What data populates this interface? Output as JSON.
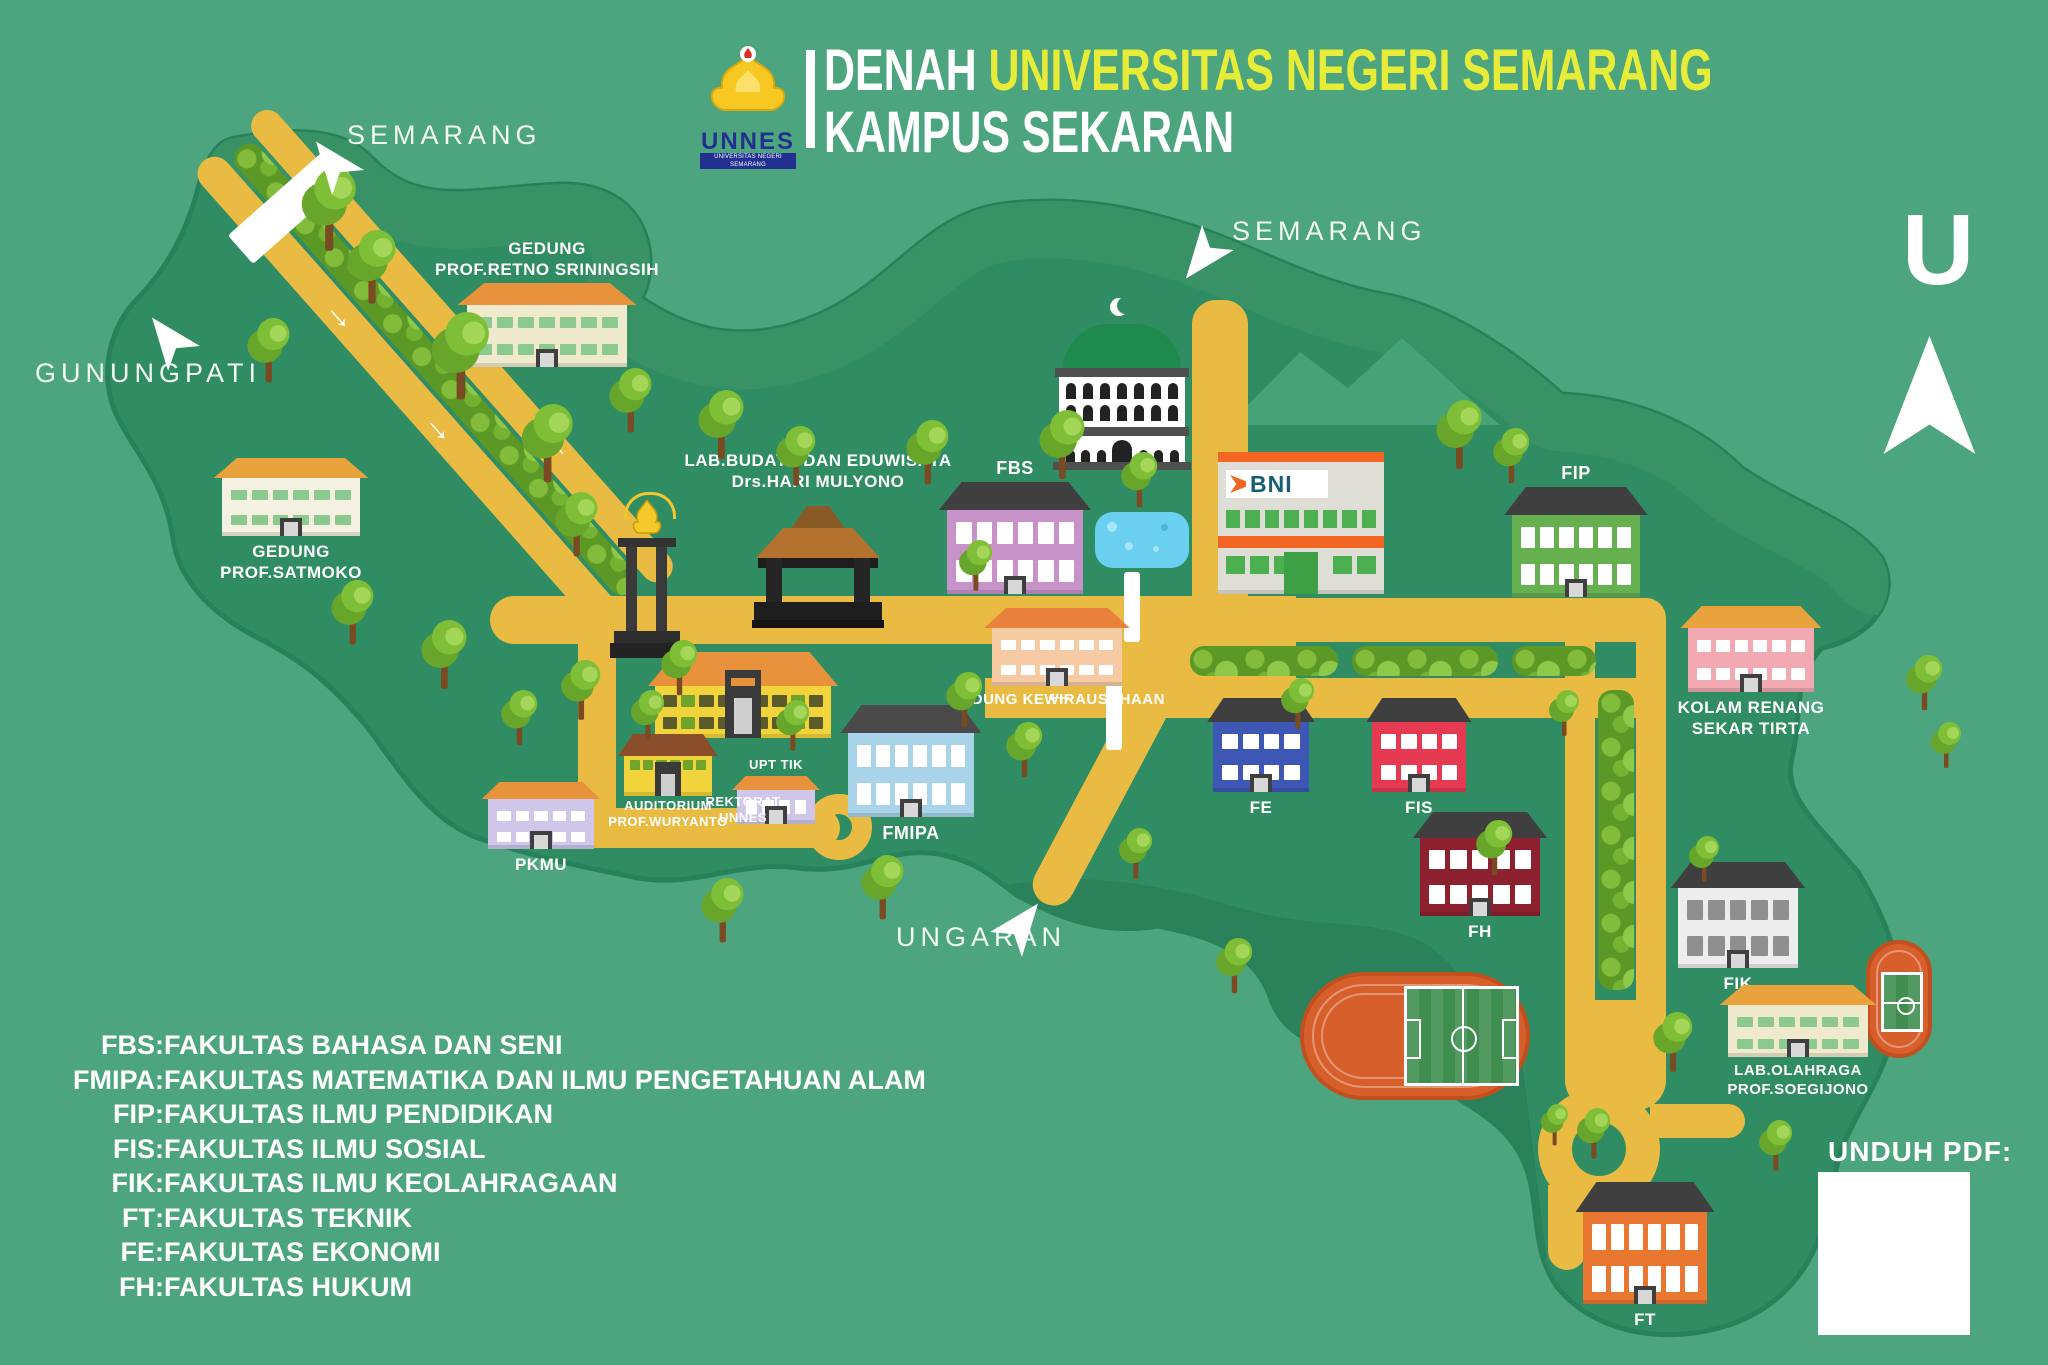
{
  "header": {
    "title_prefix": "DENAH ",
    "title_highlight": "UNIVERSITAS NEGERI SEMARANG",
    "subtitle": "KAMPUS SEKARAN",
    "logo": {
      "acronym": "UNNES",
      "full": "UNIVERSITAS NEGERI SEMARANG"
    }
  },
  "compass": {
    "label": "U"
  },
  "directions": {
    "semarang_nw": "SEMARANG",
    "gunungpati": "GUNUNGPATI",
    "semarang_n": "SEMARANG",
    "ungaran": "UNGARAN"
  },
  "download": {
    "label": "UNDUH PDF:"
  },
  "legend": {
    "items": [
      {
        "abbr": "FBS",
        "name": "FAKULTAS BAHASA DAN SENI"
      },
      {
        "abbr": "FMIPA",
        "name": "FAKULTAS MATEMATIKA DAN ILMU PENGETAHUAN ALAM"
      },
      {
        "abbr": "FIP",
        "name": "FAKULTAS ILMU PENDIDIKAN"
      },
      {
        "abbr": "FIS",
        "name": "FAKULTAS ILMU SOSIAL"
      },
      {
        "abbr": "FIK",
        "name": "FAKULTAS ILMU KEOLAHRAGAAN"
      },
      {
        "abbr": "FT",
        "name": "FAKULTAS TEKNIK"
      },
      {
        "abbr": "FE",
        "name": "FAKULTAS EKONOMI"
      },
      {
        "abbr": "FH",
        "name": "FAKULTAS HUKUM"
      }
    ]
  },
  "map": {
    "buildings": [
      {
        "id": "retno",
        "label": [
          "GEDUNG",
          "PROF.RETNO SRININGSIH"
        ],
        "body": "#EFE9CD",
        "roof": "#E8923C",
        "win": "#8CC98F"
      },
      {
        "id": "satmoko",
        "label": [
          "GEDUNG",
          "PROF.SATMOKO"
        ],
        "body": "#F4F0E2",
        "roof": "#E8A33C",
        "win": "#8CC98F"
      },
      {
        "id": "fbs",
        "label": [
          "FBS"
        ],
        "body": "#C792C8",
        "roof": "#3F3F3F",
        "win": "#FFFFFF"
      },
      {
        "id": "kewirausahaan",
        "label": [
          "GEDUNG KEWIRAUSAHAAN"
        ],
        "body": "#F6CBA4",
        "roof": "#E8813C",
        "win": "#FFFFFF"
      },
      {
        "id": "fip",
        "label": [
          "FIP"
        ],
        "body": "#67B04F",
        "roof": "#3F3F3F",
        "win": "#FFFFFF"
      },
      {
        "id": "kolam_renang",
        "label": [
          "KOLAM RENANG",
          "SEKAR TIRTA"
        ],
        "body": "#F2A9B2",
        "roof": "#E8A33C",
        "win": "#FFFFFF"
      },
      {
        "id": "upt_tik",
        "label": [
          "UPT TIK"
        ],
        "body": "#CFC6E9",
        "roof": "#E8923C",
        "win": "#FFFFFF"
      },
      {
        "id": "fmipa",
        "label": [
          "FMIPA"
        ],
        "body": "#A9D3E9",
        "roof": "#4A4A4A",
        "win": "#FFFFFF"
      },
      {
        "id": "pkmu",
        "label": [
          "PKMU"
        ],
        "body": "#CFC6E9",
        "roof": "#E8923C",
        "win": "#FFFFFF"
      },
      {
        "id": "fe",
        "label": [
          "FE"
        ],
        "body": "#3E57B5",
        "roof": "#3F3F3F",
        "win": "#FFFFFF"
      },
      {
        "id": "fis",
        "label": [
          "FIS"
        ],
        "body": "#E63A52",
        "roof": "#3F3F3F",
        "win": "#FFFFFF"
      },
      {
        "id": "fh",
        "label": [
          "FH"
        ],
        "body": "#8E2130",
        "roof": "#3F3F3F",
        "win": "#FFFFFF"
      },
      {
        "id": "fik",
        "label": [
          "FIK"
        ],
        "body": "#EDEDED",
        "roof": "#3F3F3F",
        "win": "#8F8F8F"
      },
      {
        "id": "lab_olahraga",
        "label": [
          "LAB.OLAHRAGA",
          "PROF.SOEGIJONO"
        ],
        "body": "#EFE9CD",
        "roof": "#E8A33C",
        "win": "#8CC98F"
      },
      {
        "id": "ft",
        "label": [
          "FT"
        ],
        "body": "#E97631",
        "roof": "#3F3F3F",
        "win": "#FFFFFF"
      }
    ],
    "special": {
      "rektorat": {
        "label": [
          "REKTORAT",
          "UNNES"
        ]
      },
      "auditorium": {
        "label": [
          "AUDITORIUM",
          "PROF.WURYANTO"
        ]
      },
      "lab_budaya": {
        "label": [
          "LAB.BUDAYA DAN EDUWISATA",
          "Drs.HARI MULYONO"
        ]
      },
      "bni": {
        "label": "BNI"
      }
    },
    "colors": {
      "background": "#4CA57E",
      "land": "#2F8C63",
      "road": "#E9BB43",
      "hedge_green": "#5C9826",
      "water": "#6BD0F0",
      "track_orange": "#D65F2C",
      "pitch_green": "#3F8E4F",
      "title_highlight": "#E7EC39",
      "mosque_dome": "#1F8A4D",
      "bni_orange": "#F26522",
      "bni_blue": "#175E74"
    }
  }
}
